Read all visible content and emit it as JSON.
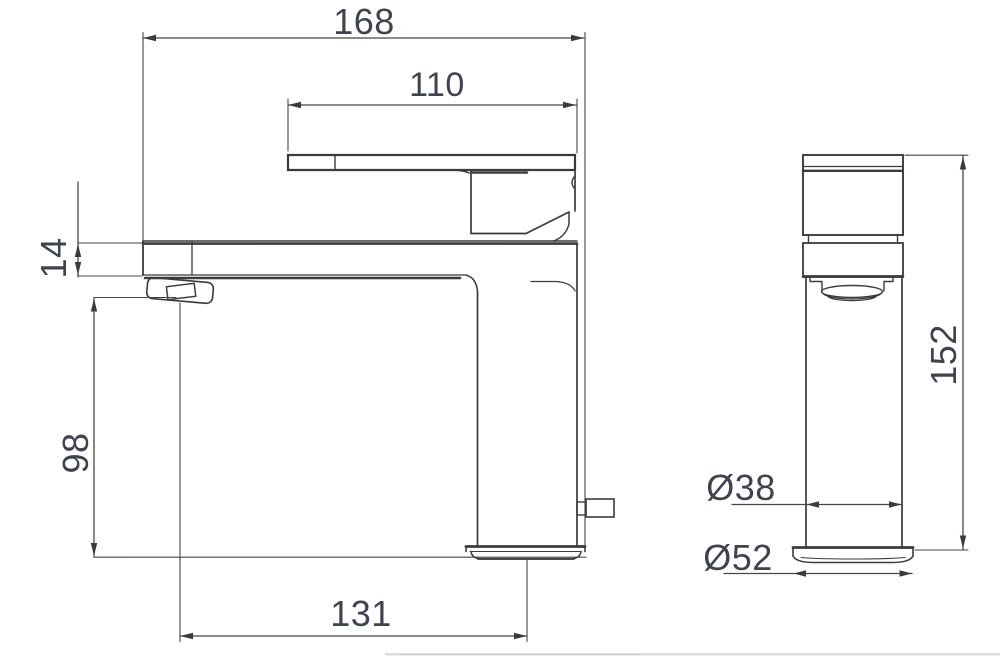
{
  "drawing": {
    "background_color": "#ffffff",
    "line_color": "#3b3b3b",
    "dimension_text_color": "#3d4450",
    "dimensions": {
      "overall_length": {
        "value": "168"
      },
      "handle_length": {
        "value": "110"
      },
      "spout_thickness": {
        "value": "14"
      },
      "spout_height": {
        "value": "98"
      },
      "spout_reach": {
        "value": "131"
      },
      "overall_height": {
        "value": "152"
      },
      "body_diameter": {
        "value": "Ø38"
      },
      "base_diameter": {
        "value": "Ø52"
      }
    }
  }
}
